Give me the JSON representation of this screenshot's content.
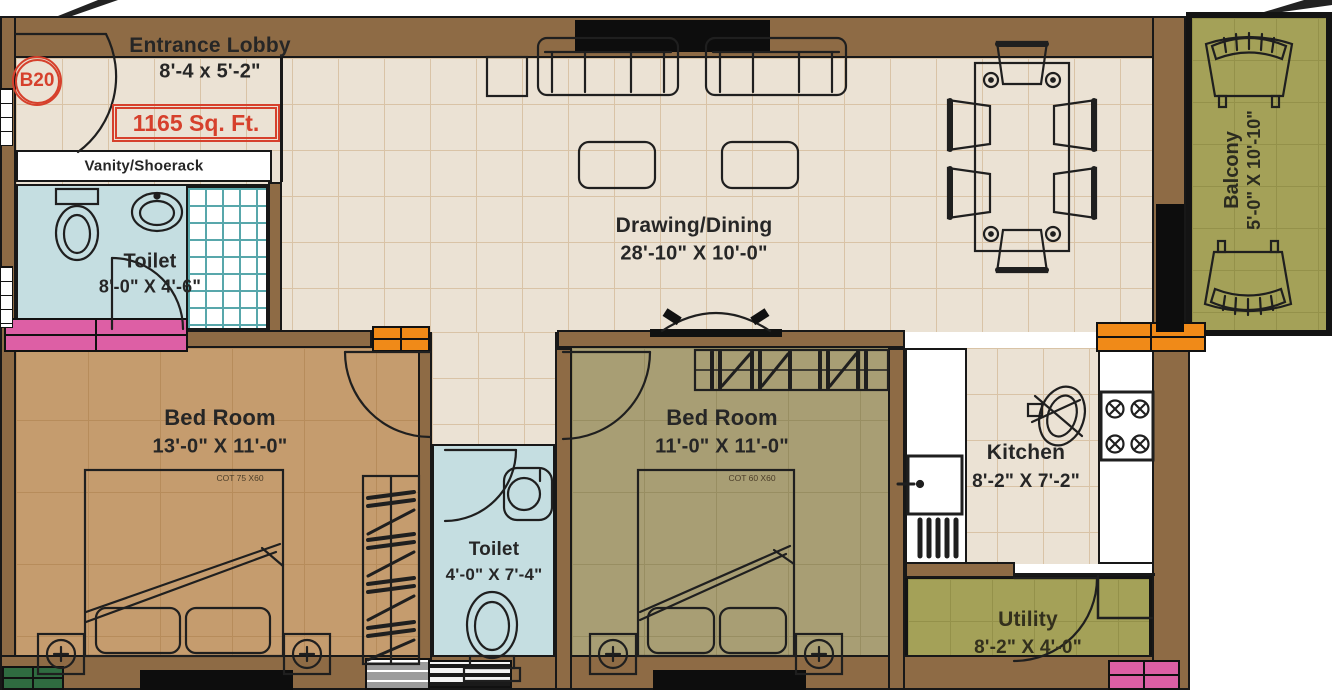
{
  "unit": {
    "badge": "B20",
    "total_area": "1165 Sq. Ft."
  },
  "rooms": {
    "entrance_lobby": {
      "name": "Entrance Lobby",
      "dimensions": "8'-4 x 5'-2\""
    },
    "vanity": {
      "name": "Vanity/Shoerack"
    },
    "toilet1": {
      "name": "Toilet",
      "dimensions": "8'-0\" X 4'-6\""
    },
    "drawing_dining": {
      "name": "Drawing/Dining",
      "dimensions": "28'-10\" X 10'-0\""
    },
    "balcony": {
      "name": "Balcony",
      "dimensions": "5'-0\" X 10'-10\""
    },
    "bedroom1": {
      "name": "Bed Room",
      "dimensions": "13'-0\" X 11'-0\"",
      "cot": "COT 75 X60"
    },
    "bedroom2": {
      "name": "Bed Room",
      "dimensions": "11'-0\" X 11'-0\"",
      "cot": "COT 60 X60"
    },
    "toilet2": {
      "name": "Toilet",
      "dimensions": "4'-0\" X 7'-4\""
    },
    "kitchen": {
      "name": "Kitchen",
      "dimensions": "8'-2\" X 7'-2\""
    },
    "utility": {
      "name": "Utility",
      "dimensions": "8'-2\" X 4'-0\""
    }
  },
  "colors": {
    "wall_brown": "#8E6B45",
    "floor_cream": "#EBE2D4",
    "floor_bedroom1": "#C59C6E",
    "floor_bedroom2": "#A89E74",
    "floor_toilet": "#C5DEE1",
    "floor_balcony_utility": "#A4A158",
    "accent_red": "#d6402c",
    "window_pink": "#DD5FA5",
    "window_orange": "#F08A18",
    "window_green": "#2F6B40",
    "tile_teal": "#58a7ab"
  }
}
